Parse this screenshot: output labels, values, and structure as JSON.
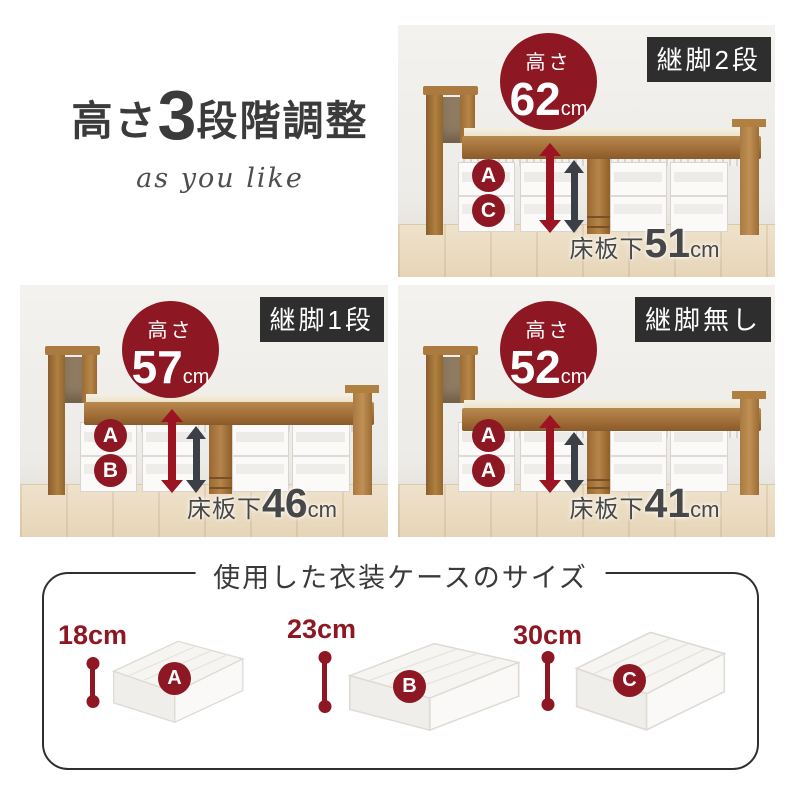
{
  "header": {
    "title_prefix": "高さ",
    "title_number": "3",
    "title_suffix": "段階調整",
    "tagline": "as you like"
  },
  "panels": [
    {
      "badge": "継脚2段",
      "height_label": "高さ",
      "height_value": "62",
      "height_unit": "cm",
      "letters": [
        "A",
        "C"
      ],
      "under_label": "床板下",
      "under_value": "51",
      "under_unit": "cm"
    },
    {
      "badge": "継脚1段",
      "height_label": "高さ",
      "height_value": "57",
      "height_unit": "cm",
      "letters": [
        "A",
        "B"
      ],
      "under_label": "床板下",
      "under_value": "46",
      "under_unit": "cm"
    },
    {
      "badge": "継脚無し",
      "height_label": "高さ",
      "height_value": "52",
      "height_unit": "cm",
      "letters": [
        "A",
        "A"
      ],
      "under_label": "床板下",
      "under_value": "41",
      "under_unit": "cm"
    }
  ],
  "cases_section": {
    "title": "使用した衣装ケースのサイズ",
    "cases": [
      {
        "letter": "A",
        "size": "18cm"
      },
      {
        "letter": "B",
        "size": "23cm"
      },
      {
        "letter": "C",
        "size": "30cm"
      }
    ]
  },
  "colors": {
    "accent_maroon": "#8d1722",
    "arrow_red": "#9c1322",
    "arrow_gray": "#3a4046",
    "badge_bg": "#2e2e2e",
    "title_text": "#3b3b3b",
    "wood": "#a8743f"
  }
}
